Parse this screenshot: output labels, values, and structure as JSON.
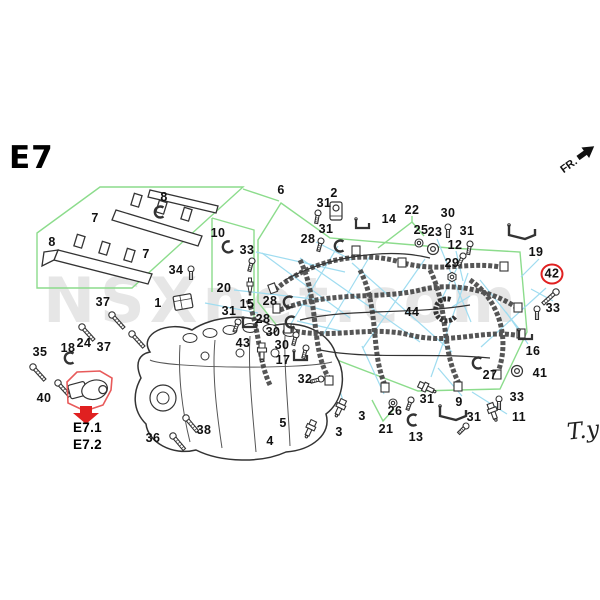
{
  "page": {
    "diagram_code": "E7",
    "direction_label": "FR.",
    "watermark": "NSXnet.com",
    "signature": "T.y",
    "sub_refs": [
      "E7.1",
      "E7.2"
    ]
  },
  "colors": {
    "region_green": "#8cdc8c",
    "leader_cyan": "#9fdcf0",
    "highlight_red": "#e02020",
    "ink": "#333333",
    "watermark_gray": "#cfcfcf"
  },
  "callouts": [
    {
      "n": "7",
      "x": 95,
      "y": 218
    },
    {
      "n": "8",
      "x": 164,
      "y": 197
    },
    {
      "n": "8",
      "x": 52,
      "y": 242
    },
    {
      "n": "7",
      "x": 146,
      "y": 254
    },
    {
      "n": "6",
      "x": 281,
      "y": 190
    },
    {
      "n": "10",
      "x": 218,
      "y": 233
    },
    {
      "n": "33",
      "x": 247,
      "y": 250
    },
    {
      "n": "34",
      "x": 176,
      "y": 270
    },
    {
      "n": "20",
      "x": 224,
      "y": 288
    },
    {
      "n": "1",
      "x": 158,
      "y": 303
    },
    {
      "n": "37",
      "x": 103,
      "y": 302
    },
    {
      "n": "24",
      "x": 84,
      "y": 343
    },
    {
      "n": "37",
      "x": 104,
      "y": 347
    },
    {
      "n": "18",
      "x": 68,
      "y": 348
    },
    {
      "n": "35",
      "x": 40,
      "y": 352
    },
    {
      "n": "40",
      "x": 44,
      "y": 398
    },
    {
      "n": "36",
      "x": 153,
      "y": 438
    },
    {
      "n": "38",
      "x": 204,
      "y": 430
    },
    {
      "n": "2",
      "x": 334,
      "y": 193
    },
    {
      "n": "31",
      "x": 324,
      "y": 203
    },
    {
      "n": "31",
      "x": 326,
      "y": 229
    },
    {
      "n": "14",
      "x": 389,
      "y": 219
    },
    {
      "n": "22",
      "x": 412,
      "y": 210
    },
    {
      "n": "25",
      "x": 421,
      "y": 230
    },
    {
      "n": "23",
      "x": 435,
      "y": 232
    },
    {
      "n": "30",
      "x": 448,
      "y": 213
    },
    {
      "n": "31",
      "x": 467,
      "y": 231
    },
    {
      "n": "12",
      "x": 455,
      "y": 245
    },
    {
      "n": "29",
      "x": 452,
      "y": 263
    },
    {
      "n": "19",
      "x": 536,
      "y": 252
    },
    {
      "n": "42",
      "x": 552,
      "y": 274,
      "circled": true
    },
    {
      "n": "33",
      "x": 553,
      "y": 308
    },
    {
      "n": "28",
      "x": 308,
      "y": 239
    },
    {
      "n": "15",
      "x": 247,
      "y": 304
    },
    {
      "n": "28",
      "x": 270,
      "y": 301
    },
    {
      "n": "28",
      "x": 263,
      "y": 319
    },
    {
      "n": "31",
      "x": 229,
      "y": 311
    },
    {
      "n": "30",
      "x": 273,
      "y": 332
    },
    {
      "n": "30",
      "x": 282,
      "y": 345
    },
    {
      "n": "43",
      "x": 243,
      "y": 343
    },
    {
      "n": "17",
      "x": 283,
      "y": 360
    },
    {
      "n": "32",
      "x": 305,
      "y": 379
    },
    {
      "n": "5",
      "x": 283,
      "y": 423
    },
    {
      "n": "4",
      "x": 270,
      "y": 441
    },
    {
      "n": "3",
      "x": 362,
      "y": 416
    },
    {
      "n": "3",
      "x": 339,
      "y": 432
    },
    {
      "n": "21",
      "x": 386,
      "y": 429
    },
    {
      "n": "26",
      "x": 395,
      "y": 411
    },
    {
      "n": "31",
      "x": 427,
      "y": 399
    },
    {
      "n": "13",
      "x": 416,
      "y": 437
    },
    {
      "n": "9",
      "x": 459,
      "y": 402
    },
    {
      "n": "31",
      "x": 474,
      "y": 417
    },
    {
      "n": "11",
      "x": 519,
      "y": 417
    },
    {
      "n": "16",
      "x": 533,
      "y": 351
    },
    {
      "n": "27",
      "x": 490,
      "y": 375
    },
    {
      "n": "41",
      "x": 540,
      "y": 373
    },
    {
      "n": "33",
      "x": 517,
      "y": 397
    },
    {
      "n": "44",
      "x": 412,
      "y": 312
    }
  ],
  "green_regions": [
    {
      "points": "37,233 100,187 243,187 132,288 37,288",
      "closed": true
    },
    {
      "points": "243,189 279,201",
      "closed": false
    },
    {
      "points": "212,218 254,230 254,338 226,356",
      "closed": false
    },
    {
      "points": "212,218 212,292",
      "closed": false
    },
    {
      "points": "281,203 330,238 450,248 520,252 527,332 500,389 418,391 290,342 258,302 258,240",
      "closed": true
    },
    {
      "points": "378,248 412,222 412,216",
      "closed": false
    },
    {
      "points": "412,222 424,236",
      "closed": false
    },
    {
      "points": "372,400 383,421 394,409",
      "closed": false
    },
    {
      "points": "263,398 270,434",
      "closed": false
    },
    {
      "points": "282,416 279,401",
      "closed": false
    }
  ],
  "leader_lines": [
    {
      "x1": 256,
      "y1": 252,
      "x2": 345,
      "y2": 272
    },
    {
      "x1": 234,
      "y1": 290,
      "x2": 322,
      "y2": 300
    },
    {
      "x1": 205,
      "y1": 303,
      "x2": 258,
      "y2": 313
    },
    {
      "x1": 316,
      "y1": 242,
      "x2": 352,
      "y2": 260
    },
    {
      "x1": 296,
      "y1": 303,
      "x2": 331,
      "y2": 312
    },
    {
      "x1": 297,
      "y1": 321,
      "x2": 341,
      "y2": 331
    },
    {
      "x1": 437,
      "y1": 239,
      "x2": 471,
      "y2": 322
    },
    {
      "x1": 456,
      "y1": 251,
      "x2": 463,
      "y2": 281
    },
    {
      "x1": 457,
      "y1": 268,
      "x2": 441,
      "y2": 300
    },
    {
      "x1": 546,
      "y1": 288,
      "x2": 481,
      "y2": 347
    },
    {
      "x1": 539,
      "y1": 259,
      "x2": 521,
      "y2": 277
    },
    {
      "x1": 528,
      "y1": 344,
      "x2": 506,
      "y2": 312
    },
    {
      "x1": 452,
      "y1": 307,
      "x2": 470,
      "y2": 296
    },
    {
      "x1": 462,
      "y1": 396,
      "x2": 438,
      "y2": 368
    },
    {
      "x1": 507,
      "y1": 414,
      "x2": 472,
      "y2": 392
    },
    {
      "x1": 384,
      "y1": 394,
      "x2": 362,
      "y2": 346
    },
    {
      "x1": 344,
      "y1": 404,
      "x2": 331,
      "y2": 362
    },
    {
      "x1": 314,
      "y1": 423,
      "x2": 303,
      "y2": 394
    },
    {
      "x1": 299,
      "y1": 337,
      "x2": 333,
      "y2": 360
    },
    {
      "x1": 553,
      "y1": 301,
      "x2": 531,
      "y2": 289
    },
    {
      "x1": 300,
      "y1": 258,
      "x2": 420,
      "y2": 342
    },
    {
      "x1": 338,
      "y1": 246,
      "x2": 289,
      "y2": 327
    },
    {
      "x1": 425,
      "y1": 259,
      "x2": 363,
      "y2": 348
    },
    {
      "x1": 468,
      "y1": 273,
      "x2": 431,
      "y2": 377
    },
    {
      "x1": 352,
      "y1": 263,
      "x2": 452,
      "y2": 352
    },
    {
      "x1": 262,
      "y1": 253,
      "x2": 350,
      "y2": 318
    },
    {
      "x1": 370,
      "y1": 256,
      "x2": 320,
      "y2": 340
    },
    {
      "x1": 480,
      "y1": 280,
      "x2": 520,
      "y2": 330
    }
  ],
  "part_glyphs": [
    {
      "t": "bolt",
      "x": 252,
      "y": 261,
      "r": 15
    },
    {
      "t": "bolt",
      "x": 191,
      "y": 269,
      "r": 0
    },
    {
      "t": "lbolt",
      "x": 112,
      "y": 315,
      "r": -42
    },
    {
      "t": "lbolt",
      "x": 82,
      "y": 327,
      "r": -42
    },
    {
      "t": "lbolt",
      "x": 132,
      "y": 334,
      "r": -42
    },
    {
      "t": "lbolt",
      "x": 33,
      "y": 367,
      "r": -42
    },
    {
      "t": "lbolt",
      "x": 58,
      "y": 383,
      "r": -42
    },
    {
      "t": "lbolt",
      "x": 173,
      "y": 436,
      "r": -40
    },
    {
      "t": "lbolt",
      "x": 186,
      "y": 418,
      "r": -40
    },
    {
      "t": "bolt",
      "x": 318,
      "y": 213,
      "r": 10
    },
    {
      "t": "bolt",
      "x": 321,
      "y": 241,
      "r": 15
    },
    {
      "t": "bolt",
      "x": 238,
      "y": 322,
      "r": 20
    },
    {
      "t": "bolt",
      "x": 296,
      "y": 335,
      "r": 15
    },
    {
      "t": "bolt",
      "x": 306,
      "y": 348,
      "r": 15
    },
    {
      "t": "bolt",
      "x": 321,
      "y": 379,
      "r": 75
    },
    {
      "t": "bolt",
      "x": 448,
      "y": 227,
      "r": 0
    },
    {
      "t": "bolt",
      "x": 470,
      "y": 244,
      "r": 10
    },
    {
      "t": "bolt",
      "x": 463,
      "y": 256,
      "r": 25
    },
    {
      "t": "bolt",
      "x": 537,
      "y": 309,
      "r": 0
    },
    {
      "t": "bolt",
      "x": 499,
      "y": 399,
      "r": 0
    },
    {
      "t": "bolt",
      "x": 411,
      "y": 400,
      "r": 20
    },
    {
      "t": "bolt",
      "x": 466,
      "y": 426,
      "r": 45
    },
    {
      "t": "lbolt",
      "x": 556,
      "y": 292,
      "r": 48
    },
    {
      "t": "nut",
      "x": 452,
      "y": 277,
      "r": 0
    },
    {
      "t": "washer",
      "x": 419,
      "y": 243,
      "r": 0
    },
    {
      "t": "washer",
      "x": 393,
      "y": 403,
      "r": 0
    },
    {
      "t": "grommet",
      "x": 433,
      "y": 249,
      "r": 0
    },
    {
      "t": "grommet",
      "x": 517,
      "y": 371,
      "r": 0
    },
    {
      "t": "plug",
      "x": 250,
      "y": 288,
      "r": 0
    },
    {
      "t": "sensor",
      "x": 340,
      "y": 408,
      "r": 25
    },
    {
      "t": "sensor",
      "x": 310,
      "y": 429,
      "r": 25
    },
    {
      "t": "sensor",
      "x": 427,
      "y": 388,
      "r": -65
    },
    {
      "t": "sensor",
      "x": 262,
      "y": 352,
      "r": 0
    },
    {
      "t": "sensor",
      "x": 493,
      "y": 412,
      "r": -20
    },
    {
      "t": "clamp",
      "x": 340,
      "y": 246,
      "r": 0
    },
    {
      "t": "clamp",
      "x": 289,
      "y": 302,
      "r": 0
    },
    {
      "t": "clamp",
      "x": 291,
      "y": 322,
      "r": 0
    },
    {
      "t": "clamp",
      "x": 70,
      "y": 358,
      "r": 0
    },
    {
      "t": "clamp",
      "x": 413,
      "y": 420,
      "r": 0
    },
    {
      "t": "clamp",
      "x": 478,
      "y": 363,
      "r": 0
    },
    {
      "t": "clamp",
      "x": 160,
      "y": 212,
      "r": 0
    },
    {
      "t": "clamp",
      "x": 228,
      "y": 247,
      "r": -20
    },
    {
      "t": "bigc",
      "x": 446,
      "y": 310,
      "r": -15
    },
    {
      "t": "bracket",
      "x": 362,
      "y": 224,
      "r": 0
    },
    {
      "t": "bracket",
      "x": 300,
      "y": 356,
      "r": 0
    },
    {
      "t": "bracket",
      "x": 249,
      "y": 323,
      "r": 0
    },
    {
      "t": "bracket",
      "x": 525,
      "y": 335,
      "r": 0
    },
    {
      "t": "lbracket",
      "x": 521,
      "y": 233,
      "r": 0
    },
    {
      "t": "lbracket",
      "x": 452,
      "y": 414,
      "r": 0
    },
    {
      "t": "coil",
      "x": 336,
      "y": 211,
      "r": 0
    },
    {
      "t": "conn",
      "x": 183,
      "y": 302,
      "r": -10
    }
  ],
  "highlight": {
    "region_points": "67,382 77,372 100,371 112,378 111,390 103,405 85,411 68,403",
    "arrow_points": "80,406 92,406 92,413 99,413 86,424 73,413 80,413"
  }
}
